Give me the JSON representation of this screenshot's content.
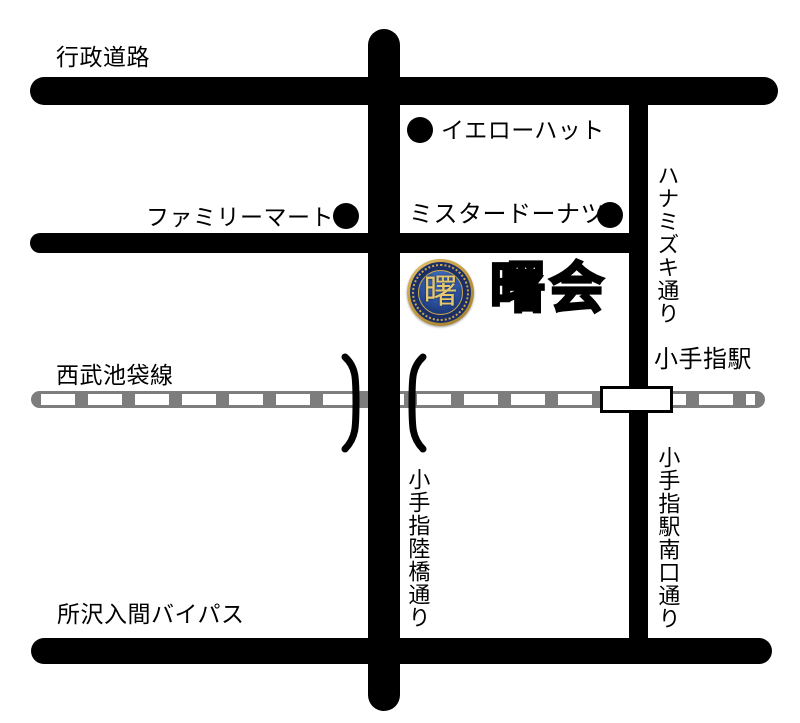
{
  "labels": {
    "gyosei_doro": "行政道路",
    "seibu_ikebukuro_line": "西武池袋線",
    "tokorozawa_iruma_bypass": "所沢入間バイパス",
    "hanamizuki_dori": "ハナミズキ通り",
    "kotesashi_rikkyo_dori": "小手指陸橋通り",
    "kotesashi_eki_minamiguchi_dori": "小手指駅南口通り",
    "kotesashi_station": "小手指駅"
  },
  "landmarks": {
    "yellow_hat": "イエローハット",
    "family_mart": "ファミリーマート",
    "mister_donut": "ミスタードーナツ"
  },
  "destination": {
    "name": "曙会",
    "logo_character": "曙"
  },
  "colors": {
    "road": "#000000",
    "railway": "#7d7d7d",
    "background": "#ffffff",
    "logo_gold": "#c49b3f",
    "logo_navy": "#1b2f66",
    "logo_blue": "#2f57a5",
    "logo_char_gold": "#e6c76d"
  }
}
